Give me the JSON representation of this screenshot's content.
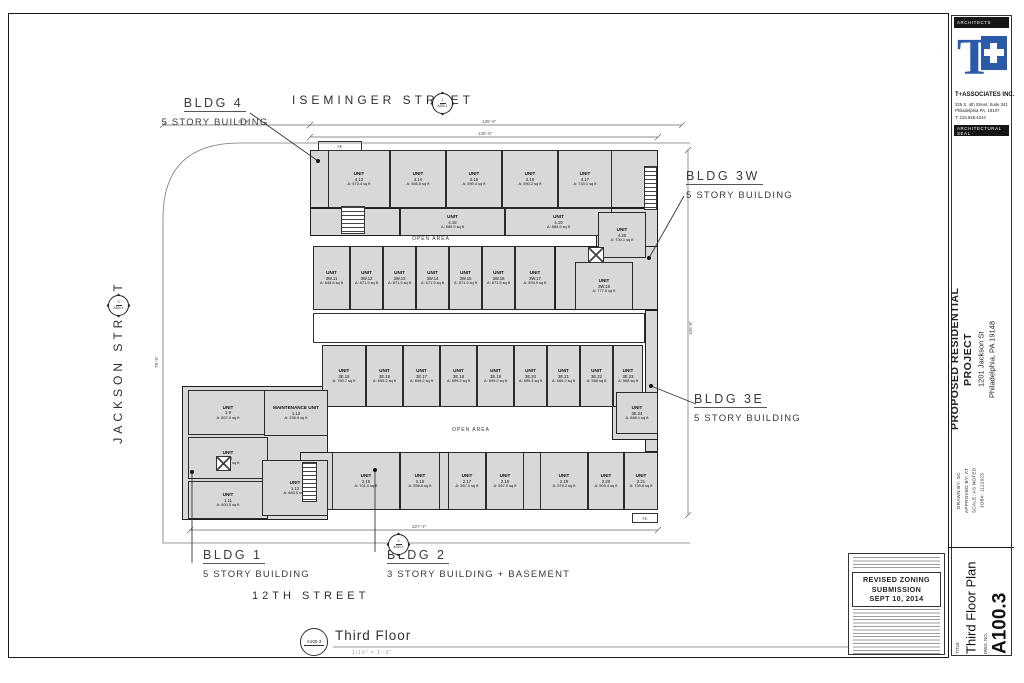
{
  "plan": {
    "unit_word": "UNIT",
    "streets": {
      "top": "ISEMINGER STREET",
      "left": "JACKSON STREET",
      "bottom": "12TH STREET"
    },
    "open_area": "OPEN AREA",
    "fe": "FE",
    "bldg_labels": [
      {
        "name": "BLDG 4",
        "sub": "5 STORY BUILDING"
      },
      {
        "name": "BLDG 3W",
        "sub": "5 STORY BUILDING"
      },
      {
        "name": "BLDG 3E",
        "sub": "5 STORY BUILDING"
      },
      {
        "name": "BLDG 1",
        "sub": "5 STORY BUILDING"
      },
      {
        "name": "BLDG 2",
        "sub": "3 STORY BUILDING + BASEMENT"
      }
    ],
    "view": {
      "marker": "A100.3",
      "title": "Third Floor",
      "scale": "1/16\" = 1'-0\""
    },
    "markers": [
      {
        "top": "1",
        "bottom": "A200.1"
      },
      {
        "top": "3",
        "bottom": "A200.1"
      },
      {
        "top": "3",
        "bottom": "A200.1"
      }
    ],
    "dims": [
      "21'-6\"",
      "135'-6\"",
      "135'-6\"",
      "227'-4\"",
      "105'-6\"",
      "76'-9\""
    ],
    "units": [
      {
        "label": "UNIT",
        "id": "4.13",
        "area": "A: 573.4 sq ft",
        "x": 328,
        "y": 150,
        "w": 62,
        "h": 58
      },
      {
        "label": "UNIT",
        "id": "4.14",
        "area": "A: 566.5 sq ft",
        "x": 390,
        "y": 150,
        "w": 56,
        "h": 58
      },
      {
        "label": "UNIT",
        "id": "4.15",
        "area": "A: 590.4 sq ft",
        "x": 446,
        "y": 150,
        "w": 56,
        "h": 58
      },
      {
        "label": "UNIT",
        "id": "4.16",
        "area": "A: 590.2 sq ft",
        "x": 502,
        "y": 150,
        "w": 56,
        "h": 58
      },
      {
        "label": "UNIT",
        "id": "4.17",
        "area": "A: 733.1 sq ft",
        "x": 558,
        "y": 150,
        "w": 54,
        "h": 58
      },
      {
        "label": "UNIT",
        "id": "4.18",
        "area": "A: 585.9 sq ft",
        "x": 400,
        "y": 208,
        "w": 105,
        "h": 28
      },
      {
        "label": "UNIT",
        "id": "4.19",
        "area": "A: 585.9 sq ft",
        "x": 505,
        "y": 208,
        "w": 107,
        "h": 28
      },
      {
        "label": "UNIT",
        "id": "4.20",
        "area": "A: 700.1 sq ft",
        "x": 598,
        "y": 212,
        "w": 48,
        "h": 46
      },
      {
        "label": "UNIT",
        "id": "3W.11",
        "area": "A: 645.6 sq ft",
        "x": 313,
        "y": 246,
        "w": 37,
        "h": 64
      },
      {
        "label": "UNIT",
        "id": "3W.12",
        "area": "A: 671.9 sq ft",
        "x": 350,
        "y": 246,
        "w": 33,
        "h": 64
      },
      {
        "label": "UNIT",
        "id": "3W.13",
        "area": "A: 671.9 sq ft",
        "x": 383,
        "y": 246,
        "w": 33,
        "h": 64
      },
      {
        "label": "UNIT",
        "id": "3W.14",
        "area": "A: 671.9 sq ft",
        "x": 416,
        "y": 246,
        "w": 33,
        "h": 64
      },
      {
        "label": "UNIT",
        "id": "3W.15",
        "area": "A: 671.9 sq ft",
        "x": 449,
        "y": 246,
        "w": 33,
        "h": 64
      },
      {
        "label": "UNIT",
        "id": "3W.16",
        "area": "A: 671.9 sq ft",
        "x": 482,
        "y": 246,
        "w": 33,
        "h": 64
      },
      {
        "label": "UNIT",
        "id": "3W.17",
        "area": "A: 594.9 sq ft",
        "x": 515,
        "y": 246,
        "w": 40,
        "h": 64
      },
      {
        "label": "UNIT",
        "id": "3W.18",
        "area": "A: 777.0 sq ft",
        "x": 575,
        "y": 262,
        "w": 58,
        "h": 48
      },
      {
        "label": "UNIT",
        "id": "3E.15",
        "area": "A: 750.7 sq ft",
        "x": 322,
        "y": 345,
        "w": 44,
        "h": 62
      },
      {
        "label": "UNIT",
        "id": "3E.16",
        "area": "A: 699.2 sq ft",
        "x": 366,
        "y": 345,
        "w": 37,
        "h": 62
      },
      {
        "label": "UNIT",
        "id": "3E.17",
        "area": "A: 699.2 sq ft",
        "x": 403,
        "y": 345,
        "w": 37,
        "h": 62
      },
      {
        "label": "UNIT",
        "id": "3E.18",
        "area": "A: 699.2 sq ft",
        "x": 440,
        "y": 345,
        "w": 37,
        "h": 62
      },
      {
        "label": "UNIT",
        "id": "3E.19",
        "area": "A: 699.2 sq ft",
        "x": 477,
        "y": 345,
        "w": 37,
        "h": 62
      },
      {
        "label": "UNIT",
        "id": "3E.20",
        "area": "A: 699.4 sq ft",
        "x": 514,
        "y": 345,
        "w": 33,
        "h": 62
      },
      {
        "label": "UNIT",
        "id": "3E.21",
        "area": "A: 666.2 sq ft",
        "x": 547,
        "y": 345,
        "w": 33,
        "h": 62
      },
      {
        "label": "UNIT",
        "id": "3E.22",
        "area": "A: 568 sq ft",
        "x": 580,
        "y": 345,
        "w": 33,
        "h": 62
      },
      {
        "label": "UNIT",
        "id": "3E.23",
        "area": "A: 568 sq ft",
        "x": 613,
        "y": 345,
        "w": 30,
        "h": 62
      },
      {
        "label": "UNIT",
        "id": "3E.24",
        "area": "A: 688.1 sq ft",
        "x": 616,
        "y": 392,
        "w": 42,
        "h": 42
      },
      {
        "label": "UNIT",
        "id": "1.9",
        "area": "A: 607.0 sq ft",
        "x": 188,
        "y": 390,
        "w": 80,
        "h": 45
      },
      {
        "label": "MAINTENANCE UNIT",
        "id": "1.13",
        "area": "A: 296.9 sq ft",
        "x": 264,
        "y": 390,
        "w": 64,
        "h": 46
      },
      {
        "label": "UNIT",
        "id": "1.10",
        "area": "A: 614.6 sq ft",
        "x": 188,
        "y": 437,
        "w": 80,
        "h": 42
      },
      {
        "label": "UNIT",
        "id": "1.11",
        "area": "A: 600.0 sq ft",
        "x": 188,
        "y": 481,
        "w": 80,
        "h": 38
      },
      {
        "label": "UNIT",
        "id": "1.12",
        "area": "A: 683.5 sq ft",
        "x": 262,
        "y": 460,
        "w": 66,
        "h": 56
      },
      {
        "label": "UNIT",
        "id": "2.15",
        "area": "A: 701.0 sq ft",
        "x": 332,
        "y": 452,
        "w": 68,
        "h": 58
      },
      {
        "label": "UNIT",
        "id": "2.16",
        "area": "A: 556.8 sq ft",
        "x": 400,
        "y": 452,
        "w": 40,
        "h": 58
      },
      {
        "label": "UNIT",
        "id": "2.17",
        "area": "A: 567.0 sq ft",
        "x": 448,
        "y": 452,
        "w": 38,
        "h": 58
      },
      {
        "label": "UNIT",
        "id": "2.18",
        "area": "A: 557.0 sq ft",
        "x": 486,
        "y": 452,
        "w": 38,
        "h": 58
      },
      {
        "label": "UNIT",
        "id": "2.19",
        "area": "A: 579.2 sq ft",
        "x": 540,
        "y": 452,
        "w": 48,
        "h": 58
      },
      {
        "label": "UNIT",
        "id": "2.20",
        "area": "A: 503.4 sq ft",
        "x": 588,
        "y": 452,
        "w": 36,
        "h": 58
      },
      {
        "label": "UNIT",
        "id": "2.21",
        "area": "A: 739.8 sq ft",
        "x": 624,
        "y": 452,
        "w": 34,
        "h": 58
      }
    ]
  },
  "titleblock": {
    "architects_header": "ARCHITECTS",
    "firm": "T+ASSOCIATES INC.",
    "logo_text": "T",
    "address1": "325 S. 4th Street, Suite 341",
    "address2": "Philadelphia PA, 19107",
    "phone": "T: 215.629.4244",
    "seal_header": "ARCHITECTURAL SEAL",
    "project_title1": "PROPOSED RESIDENTIAL",
    "project_title2": "PROJECT",
    "project_addr1": "1201 Jackson St",
    "project_addr2": "Philadelphia, PA 19148",
    "drawn_by": "DRAWN BY: SC",
    "approved_by": "APPROVED BY: AT",
    "scale": "SCALE: AS NOTED",
    "job": "JOB#: 1112023",
    "title_label": "TITLE",
    "sheet_title": "Third Floor Plan",
    "dwg_no_label": "DWG. NO.",
    "dwg_no": "A100.3",
    "submission": {
      "line1": "REVISED ZONING",
      "line2": "SUBMISSION",
      "line3": "SEPT 10, 2014"
    }
  }
}
